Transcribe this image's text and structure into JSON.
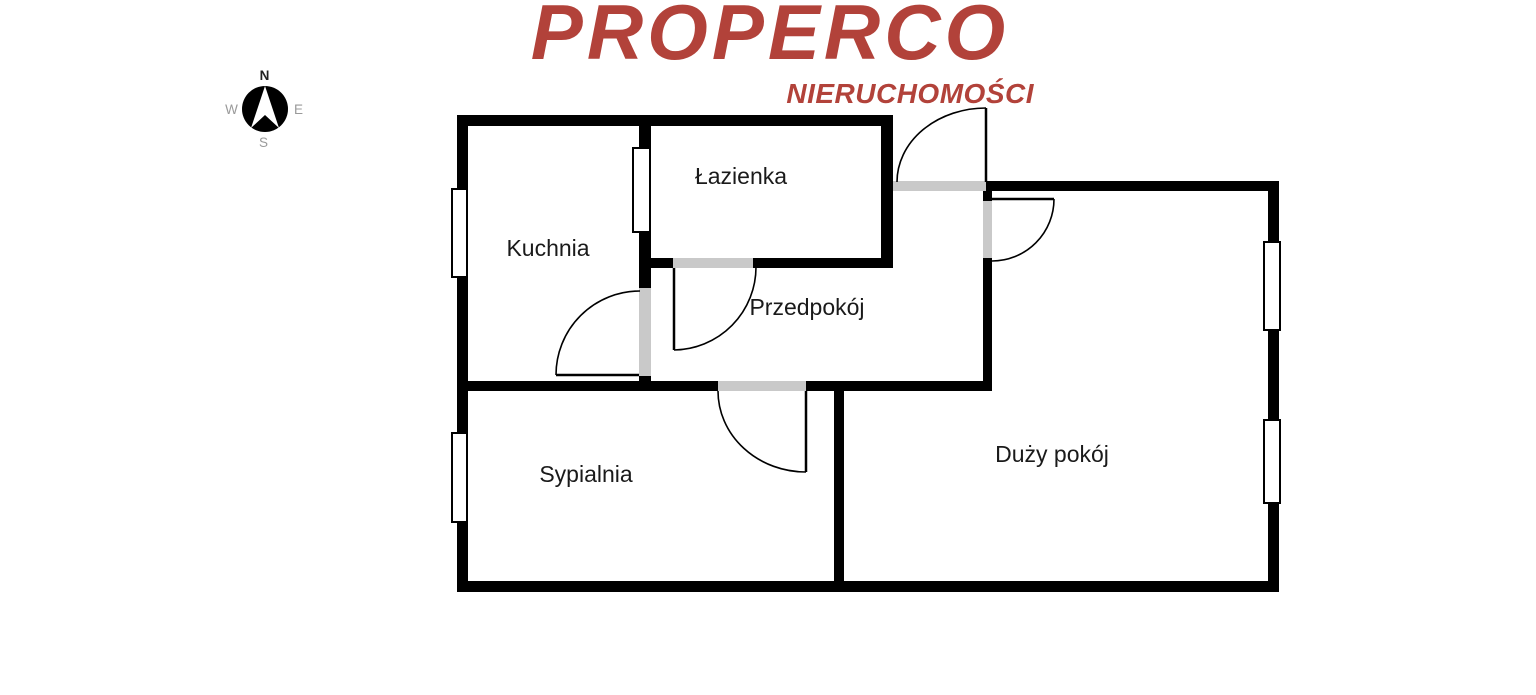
{
  "brand": {
    "title": "PROPERCO",
    "subtitle": "NIERUCHOMOŚCI",
    "color": "#B2423A"
  },
  "compass": {
    "north": "N",
    "east": "E",
    "south": "S",
    "west": "W"
  },
  "rooms": [
    {
      "label": "Kuchnia"
    },
    {
      "label": "Łazienka"
    },
    {
      "label": "Przedpokój"
    },
    {
      "label": "Sypialnia"
    },
    {
      "label": "Duży pokój"
    }
  ],
  "colors": {
    "wall": "#000000",
    "door_opening": "#c9c9c9",
    "background": "#ffffff",
    "room_label": "#1a1a1a"
  }
}
